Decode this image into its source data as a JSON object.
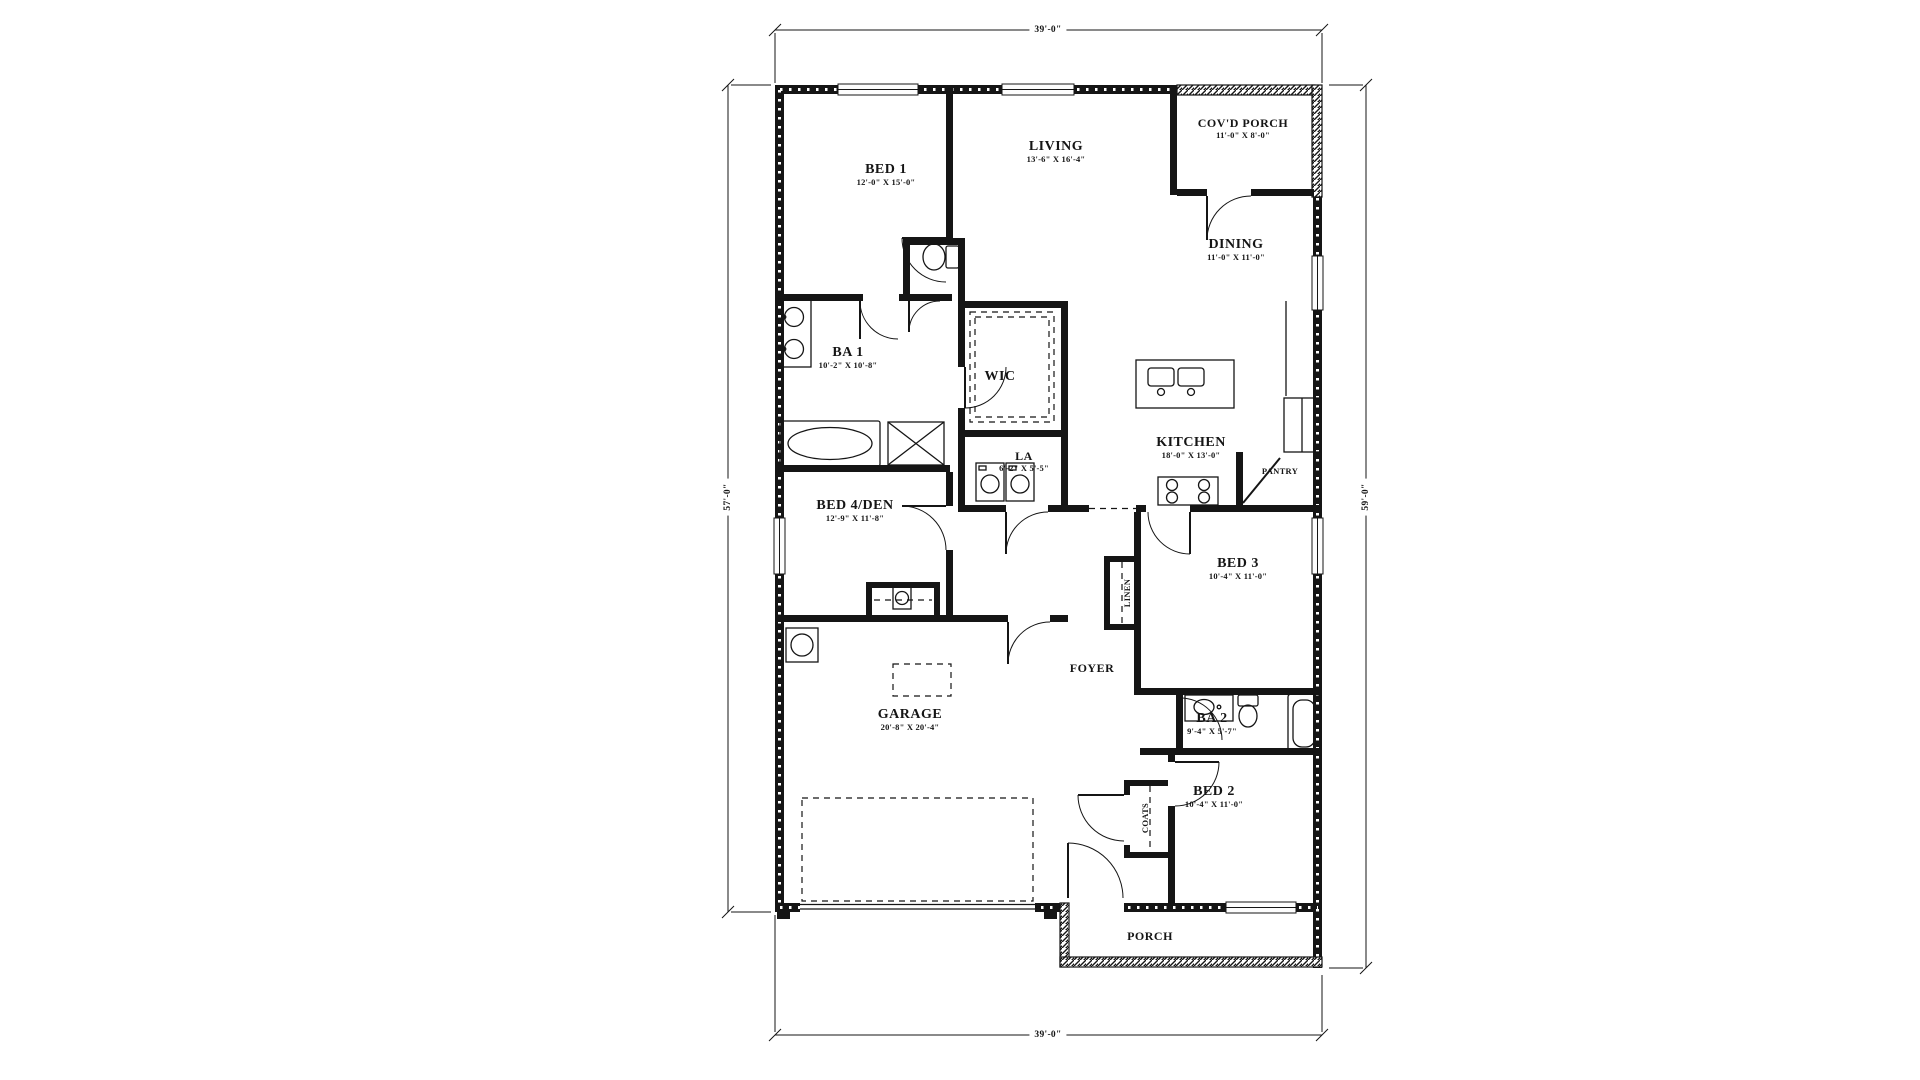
{
  "drawing": {
    "type": "residential floor plan",
    "colors": {
      "wall": "#151515",
      "paper": "#ffffff",
      "window": "#f2f2f2"
    }
  },
  "dimensions": {
    "top": "39'-0\"",
    "bottom": "39'-0\"",
    "left": "57'-0\"",
    "right": "59'-0\""
  },
  "rooms": [
    {
      "id": "bed1",
      "name": "BED 1",
      "size": "12'-0\" X 15'-0\""
    },
    {
      "id": "living",
      "name": "LIVING",
      "size": "13'-6\" X 16'-4\""
    },
    {
      "id": "covd_porch",
      "name": "COV'D PORCH",
      "size": "11'-0\" X 8'-0\""
    },
    {
      "id": "dining",
      "name": "DINING",
      "size": "11'-0\" X 11'-0\""
    },
    {
      "id": "ba1",
      "name": "BA 1",
      "size": "10'-2\" X 10'-8\""
    },
    {
      "id": "wic",
      "name": "WIC",
      "size": ""
    },
    {
      "id": "la",
      "name": "LA",
      "size": "6'-2\" X 5'-5\""
    },
    {
      "id": "kitchen",
      "name": "KITCHEN",
      "size": "18'-0\" X 13'-0\""
    },
    {
      "id": "pantry",
      "name": "PANTRY",
      "size": ""
    },
    {
      "id": "bed4den",
      "name": "BED 4/DEN",
      "size": "12'-9\" X 11'-8\""
    },
    {
      "id": "bed3",
      "name": "BED 3",
      "size": "10'-4\" X 11'-0\""
    },
    {
      "id": "linen",
      "name": "LINEN",
      "size": ""
    },
    {
      "id": "foyer",
      "name": "FOYER",
      "size": ""
    },
    {
      "id": "garage",
      "name": "GARAGE",
      "size": "20'-8\" X 20'-4\""
    },
    {
      "id": "ba2",
      "name": "BA 2",
      "size": "9'-4\" X 5'-7\""
    },
    {
      "id": "bed2",
      "name": "BED 2",
      "size": "10'-4\" X 11'-0\""
    },
    {
      "id": "coats",
      "name": "COATS",
      "size": ""
    },
    {
      "id": "porch",
      "name": "PORCH",
      "size": ""
    }
  ]
}
